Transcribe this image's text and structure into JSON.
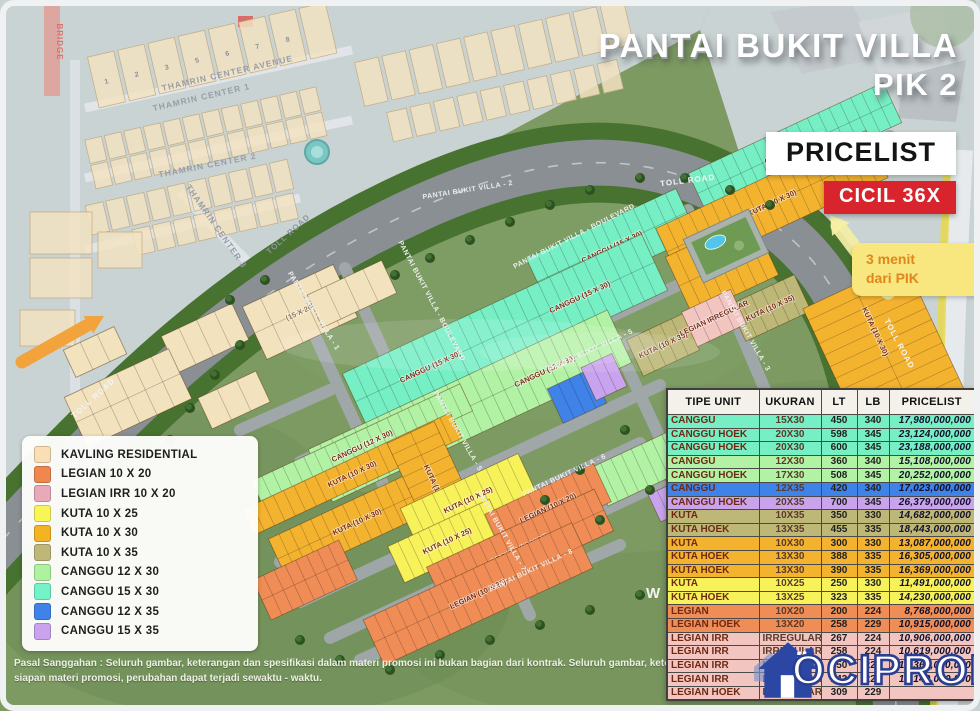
{
  "title": {
    "line1": "PANTAI BUKIT VILLA",
    "line2": "PIK 2"
  },
  "pricelist_label": "PRICELIST",
  "cicil_badge": "CICIL 36X",
  "distance_chip": {
    "line1": "3 menit",
    "line2": "dari PIK"
  },
  "brand": {
    "logo_text": "OCIPROP",
    "logo_blue": "#2B47A3"
  },
  "accents": {
    "badge_red": "#D8242C",
    "arrow_orange": "#F2A33C",
    "arrow_pale": "#F6EFA6"
  },
  "legend": {
    "items": [
      {
        "label": "KAVLING RESIDENTIAL",
        "color": "#FADFB6"
      },
      {
        "label": "LEGIAN 10 X 20",
        "color": "#F0874E"
      },
      {
        "label": "LEGIAN IRR 10 X 20",
        "color": "#E8A9B9"
      },
      {
        "label": "KUTA 10 X 25",
        "color": "#F9F457"
      },
      {
        "label": "KUTA 10 X 30",
        "color": "#F3B322"
      },
      {
        "label": "KUTA 10 X 35",
        "color": "#BDB878"
      },
      {
        "label": "CANGGU 12 X 30",
        "color": "#AEF2A0"
      },
      {
        "label": "CANGGU 15 X 30",
        "color": "#74F2C8"
      },
      {
        "label": "CANGGU 12 X 35",
        "color": "#3F82E8"
      },
      {
        "label": "CANGGU 15 X 35",
        "color": "#C9A3EE"
      }
    ]
  },
  "table": {
    "headers": [
      "TIPE UNIT",
      "UKURAN",
      "LT",
      "LB",
      "PRICELIST"
    ],
    "rows": [
      {
        "type": "CANGGU",
        "ukuran": "15X30",
        "lt": "450",
        "lb": "340",
        "price": "17,980,000,000",
        "color": "#76EFC5"
      },
      {
        "type": "CANGGU HOEK",
        "ukuran": "20X30",
        "lt": "598",
        "lb": "345",
        "price": "23,124,000,000",
        "color": "#76EFC5"
      },
      {
        "type": "CANGGU HOEK",
        "ukuran": "20X30",
        "lt": "600",
        "lb": "345",
        "price": "23,188,000,000",
        "color": "#76EFC5"
      },
      {
        "type": "CANGGU",
        "ukuran": "12X30",
        "lt": "360",
        "lb": "340",
        "price": "15,108,000,000",
        "color": "#B2F2A4"
      },
      {
        "type": "CANGGU HOEK",
        "ukuran": "17X30",
        "lt": "508",
        "lb": "345",
        "price": "20,252,000,000",
        "color": "#B2F2A4"
      },
      {
        "type": "CANGGU",
        "ukuran": "12X35",
        "lt": "420",
        "lb": "340",
        "price": "17,023,000,000",
        "color": "#3F82E8"
      },
      {
        "type": "CANGGU HOEK",
        "ukuran": "20X35",
        "lt": "700",
        "lb": "345",
        "price": "26,379,000,000",
        "color": "#C9A3EE"
      },
      {
        "type": "KUTA",
        "ukuran": "10X35",
        "lt": "350",
        "lb": "330",
        "price": "14,682,000,000",
        "color": "#BDB878"
      },
      {
        "type": "KUTA HOEK",
        "ukuran": "13X35",
        "lt": "455",
        "lb": "335",
        "price": "18,443,000,000",
        "color": "#BDB878"
      },
      {
        "type": "KUTA",
        "ukuran": "10X30",
        "lt": "300",
        "lb": "330",
        "price": "13,087,000,000",
        "color": "#F4B32F"
      },
      {
        "type": "KUTA HOEK",
        "ukuran": "13X30",
        "lt": "388",
        "lb": "335",
        "price": "16,305,000,000",
        "color": "#F4B32F"
      },
      {
        "type": "KUTA HOEK",
        "ukuran": "13X30",
        "lt": "390",
        "lb": "335",
        "price": "16,369,000,000",
        "color": "#F4B32F"
      },
      {
        "type": "KUTA",
        "ukuran": "10X25",
        "lt": "250",
        "lb": "330",
        "price": "11,491,000,000",
        "color": "#F8F25A"
      },
      {
        "type": "KUTA HOEK",
        "ukuran": "13X25",
        "lt": "323",
        "lb": "335",
        "price": "14,230,000,000",
        "color": "#F8F25A"
      },
      {
        "type": "LEGIAN",
        "ukuran": "10X20",
        "lt": "200",
        "lb": "224",
        "price": "8,768,000,000",
        "color": "#F08C55"
      },
      {
        "type": "LEGIAN HOEK",
        "ukuran": "13X20",
        "lt": "258",
        "lb": "229",
        "price": "10,915,000,000",
        "color": "#F08C55"
      },
      {
        "type": "LEGIAN IRR",
        "ukuran": "IRREGULAR",
        "lt": "267",
        "lb": "224",
        "price": "10,906,000,000",
        "color": "#F2C5C1"
      },
      {
        "type": "LEGIAN IRR",
        "ukuran": "IRREGULAR",
        "lt": "258",
        "lb": "224",
        "price": "10,619,000,000",
        "color": "#F2C5C1"
      },
      {
        "type": "LEGIAN IRR",
        "ukuran": "IRREGULAR",
        "lt": "250",
        "lb": "224",
        "price": "10,363,000,000",
        "color": "#F2C5C1"
      },
      {
        "type": "LEGIAN IRR",
        "ukuran": "IRREGULAR",
        "lt": "243",
        "lb": "224",
        "price": "10,140,000,000",
        "color": "#F2C5C1"
      },
      {
        "type": "LEGIAN HOEK",
        "ukuran": "IRREGULAR",
        "lt": "309",
        "lb": "229",
        "price": "",
        "color": "#F2C5C1"
      }
    ]
  },
  "disclaimer": {
    "line1": "Pasal Sanggahan : Seluruh gambar, keterangan dan spesifikasi dalam materi promosi ini bukan bagian dari kontrak. Seluruh gambar, keterangan dan spesifikasi disiapkan dari ke",
    "line2": "siapan materi promosi, perubahan dapat terjadi sewaktu - waktu."
  },
  "map": {
    "colors": {
      "cream": "#F3E2BE",
      "teal": "#76EFC5",
      "green": "#B2F2A4",
      "blue": "#3F82E8",
      "purple": "#C9A3EE",
      "khaki": "#BDB878",
      "amber": "#F4B32F",
      "yellow": "#F8F25A",
      "orange": "#F08C55",
      "pink": "#F2C5C1"
    },
    "strips": [
      {
        "x": 300,
        "y": 312,
        "l": 100,
        "t": 58,
        "r": -25,
        "c": "cream",
        "n": 5,
        "label": "(15 X 20)"
      },
      {
        "x": 352,
        "y": 294,
        "l": 82,
        "t": 36,
        "r": -25,
        "c": "cream",
        "n": 4
      },
      {
        "x": 205,
        "y": 338,
        "l": 78,
        "t": 40,
        "r": -25,
        "c": "cream",
        "n": 4
      },
      {
        "x": 128,
        "y": 398,
        "l": 115,
        "t": 55,
        "r": -25,
        "c": "cream",
        "n": 6
      },
      {
        "x": 95,
        "y": 352,
        "l": 56,
        "t": 30,
        "r": -25,
        "c": "cream",
        "n": 3
      },
      {
        "x": 234,
        "y": 400,
        "l": 64,
        "t": 34,
        "r": -25,
        "c": "cream",
        "n": 3
      },
      {
        "x": 612,
        "y": 247,
        "l": 165,
        "t": 52,
        "r": -25,
        "c": "teal",
        "n": 14,
        "label": "CANGGU (15 X 30)"
      },
      {
        "x": 795,
        "y": 148,
        "l": 215,
        "t": 44,
        "r": -25,
        "c": "teal",
        "n": 18,
        "label": "CANGGU (15 X 30)"
      },
      {
        "x": 772,
        "y": 203,
        "l": 232,
        "t": 52,
        "r": -25,
        "c": "amber",
        "n": 19,
        "label": "KUTA (10 X 30)"
      },
      {
        "x": 722,
        "y": 266,
        "l": 95,
        "t": 64,
        "r": -25,
        "c": "amber",
        "n": 8
      },
      {
        "x": 505,
        "y": 332,
        "l": 330,
        "t": 62,
        "r": -25,
        "c": "teal",
        "n": 26,
        "label": "CANGGU (15 X 30)",
        "label2": "CANGGU (15 X 30)"
      },
      {
        "x": 470,
        "y": 406,
        "l": 330,
        "t": 58,
        "r": -25,
        "c": "green",
        "n": 26,
        "label": "CANGGU (15 X 30)",
        "label2": "CANGGU (12 X 30)"
      },
      {
        "x": 577,
        "y": 396,
        "l": 48,
        "t": 38,
        "r": -25,
        "c": "blue",
        "n": 4
      },
      {
        "x": 604,
        "y": 377,
        "l": 34,
        "t": 36,
        "r": -25,
        "c": "purple",
        "n": 3
      },
      {
        "x": 362,
        "y": 446,
        "l": 230,
        "t": 30,
        "r": -25,
        "c": "green",
        "n": 20,
        "label": "CANGGU (12 X 30)"
      },
      {
        "x": 352,
        "y": 474,
        "l": 230,
        "t": 28,
        "r": -25,
        "c": "amber",
        "n": 20,
        "label": "KUTA (10 X 30)"
      },
      {
        "x": 640,
        "y": 468,
        "l": 90,
        "t": 42,
        "r": -25,
        "c": "green",
        "n": 8
      },
      {
        "x": 668,
        "y": 502,
        "l": 30,
        "t": 30,
        "r": -25,
        "c": "purple",
        "n": 3
      },
      {
        "x": 357,
        "y": 522,
        "l": 175,
        "t": 44,
        "r": -25,
        "c": "amber",
        "n": 15,
        "label": "KUTA (10 X 30)"
      },
      {
        "x": 437,
        "y": 489,
        "l": 125,
        "t": 52,
        "r": 65,
        "c": "amber",
        "n": 10,
        "label": "KUTA (10 X 30)"
      },
      {
        "x": 468,
        "y": 500,
        "l": 130,
        "t": 42,
        "r": -25,
        "c": "yellow",
        "n": 11,
        "label": "KUTA (10 X 25)"
      },
      {
        "x": 447,
        "y": 541,
        "l": 112,
        "t": 40,
        "r": -25,
        "c": "yellow",
        "n": 10,
        "label": "KUTA (10 X 25)"
      },
      {
        "x": 548,
        "y": 508,
        "l": 120,
        "t": 42,
        "r": -25,
        "c": "orange",
        "n": 10,
        "label": "LEGIAN (10 X 20)"
      },
      {
        "x": 520,
        "y": 549,
        "l": 185,
        "t": 46,
        "r": -25,
        "c": "orange",
        "n": 16,
        "label": "LEGIAN (10 X 20)"
      },
      {
        "x": 478,
        "y": 594,
        "l": 230,
        "t": 50,
        "r": -25,
        "c": "orange",
        "n": 19,
        "label": "LEGIAN (10 X 20)"
      },
      {
        "x": 305,
        "y": 580,
        "l": 95,
        "t": 44,
        "r": -25,
        "c": "orange",
        "n": 8
      },
      {
        "x": 663,
        "y": 345,
        "l": 62,
        "t": 40,
        "r": -25,
        "c": "khaki",
        "n": 5,
        "label": "KUTA (10 X 35)"
      },
      {
        "x": 770,
        "y": 308,
        "l": 72,
        "t": 40,
        "r": -25,
        "c": "khaki",
        "n": 6,
        "label": "KUTA (10 X 35)"
      },
      {
        "x": 888,
        "y": 547,
        "l": 115,
        "t": 46,
        "r": -25,
        "c": "khaki",
        "n": 9,
        "label": "KUTA (10 X 35)"
      },
      {
        "x": 714,
        "y": 318,
        "l": 54,
        "t": 38,
        "r": -25,
        "c": "pink",
        "n": 4,
        "label": "LEGIAN IRREGULAR"
      },
      {
        "x": 897,
        "y": 378,
        "l": 205,
        "t": 112,
        "r": 65,
        "c": "amber",
        "n": 16,
        "label": "KUTA (10 X 30)",
        "label2": "KUTA (10 X 30)"
      }
    ],
    "road_labels": [
      {
        "text": "PANTAI BUKIT VILLA - 2",
        "x": 468,
        "y": 192,
        "r": -9
      },
      {
        "text": "PANTAI BUKIT VILLA - BOULEVARD",
        "x": 575,
        "y": 238,
        "r": -27
      },
      {
        "text": "PANTAI BUKIT VILLA - BOULEVARD",
        "x": 430,
        "y": 302,
        "r": 62
      },
      {
        "text": "PANTAI BUKIT VILLA - 1",
        "x": 312,
        "y": 312,
        "r": 58
      },
      {
        "text": "PANTAI BUKIT VILLA - 3",
        "x": 744,
        "y": 332,
        "r": 60
      },
      {
        "text": "PANTAI BUKIT VILLA - 5",
        "x": 592,
        "y": 352,
        "r": -25
      },
      {
        "text": "PANTAI BUKIT VILLA - 5",
        "x": 456,
        "y": 432,
        "r": 60
      },
      {
        "text": "PANTAI BUKIT VILLA - 6",
        "x": 565,
        "y": 477,
        "r": -25
      },
      {
        "text": "PANTAI BUKIT VILLA - 7",
        "x": 500,
        "y": 532,
        "r": 60
      },
      {
        "text": "PANTAI BUKIT VILLA - 8",
        "x": 532,
        "y": 572,
        "r": -25
      }
    ],
    "toll_labels": [
      {
        "text": "TOLL ROAD",
        "x": 290,
        "y": 236,
        "r": -42,
        "muted": true
      },
      {
        "text": "TOLL ROAD",
        "x": 95,
        "y": 400,
        "r": -42
      },
      {
        "text": "TOLL ROAD",
        "x": 688,
        "y": 183,
        "r": -7
      },
      {
        "text": "TOLL ROAD",
        "x": 897,
        "y": 345,
        "r": 62
      }
    ],
    "thamrin_labels": [
      {
        "text": "THAMRIN CENTER AVENUE",
        "x": 228,
        "y": 76,
        "r": -13
      },
      {
        "text": "THAMRIN CENTER 1",
        "x": 202,
        "y": 100,
        "r": -13
      },
      {
        "text": "THAMRIN CENTER 2",
        "x": 208,
        "y": 168,
        "r": -11
      },
      {
        "text": "THAMRIN CENTER 3",
        "x": 214,
        "y": 228,
        "r": 55
      }
    ],
    "bridge_label": {
      "text": "BRIDGE",
      "x": 57,
      "y": 42,
      "r": 90
    },
    "watermark_letter": "W",
    "plot_numbers": [
      "1",
      "2",
      "3",
      "5",
      "6",
      "7",
      "8"
    ]
  }
}
